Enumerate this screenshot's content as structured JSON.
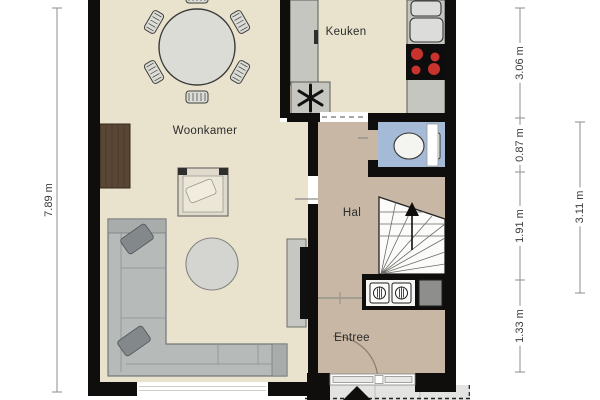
{
  "labels": {
    "rooms": {
      "woonkamer": "Woonkamer",
      "keuken": "Keuken",
      "hal": "Hal",
      "entree": "Entree"
    }
  },
  "dimensions": {
    "left_total": "7.89 m",
    "right_segments": [
      "3.06 m",
      "0.87 m",
      "1.91 m",
      "1.33 m"
    ],
    "right_outer": "3.11 m"
  },
  "colors": {
    "wall": "#0f0e0c",
    "floor-living": "#e9e3cd",
    "floor-hall": "#c8b7a5",
    "floor-toilet": "#a5bad6",
    "burner": "#c8332e",
    "porch": "#e3e3e2",
    "cabinet-brown": "#5a4635"
  },
  "fixtures": [
    "dining-table",
    "dining-chair",
    "corner-sofa",
    "throw-pillow",
    "armchair",
    "round-rug",
    "tv",
    "tv-lowboard",
    "media-cabinet-wood",
    "kitchen-counter",
    "double-sink",
    "cooktop-4-burner",
    "ventilation-unit",
    "toilet",
    "staircase-up-arrow",
    "meter-cupboard",
    "duct-shaft",
    "front-door",
    "door-arc",
    "window",
    "entrance-step-marker"
  ]
}
